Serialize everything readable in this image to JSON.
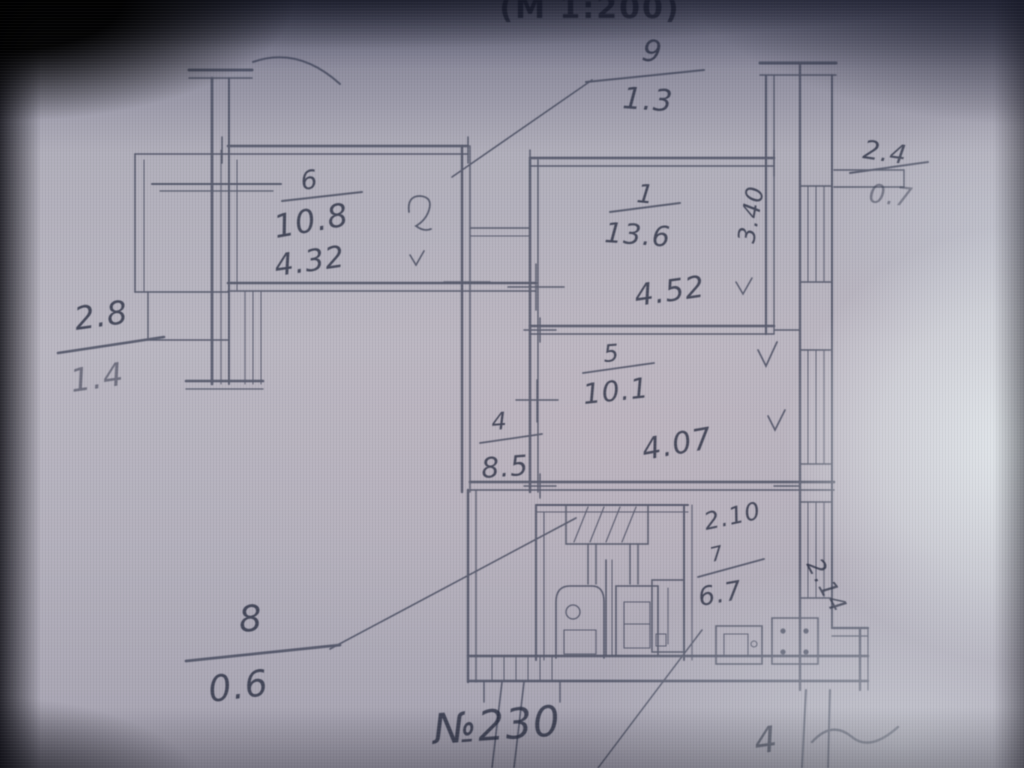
{
  "plan": {
    "scale_label": "(М 1:200)",
    "apartment_label": "№230",
    "corner_mark": "4",
    "rooms": {
      "room6": {
        "number": "6",
        "area": "10.8",
        "width": "4.32"
      },
      "room1": {
        "number": "1",
        "area": "13.6",
        "width": "4.52",
        "depth": "3.40"
      },
      "room5": {
        "number": "5",
        "area": "10.1",
        "width": "4.07"
      },
      "room4": {
        "number": "4",
        "area": "8.5"
      },
      "room7": {
        "number": "7",
        "area": "6.7",
        "dim_top": "2.10",
        "dim_side": "2.14"
      },
      "room8": {
        "number": "8",
        "area": "0.6"
      },
      "room9": {
        "number": "9",
        "area": "1.3"
      }
    },
    "balcony_left": {
      "width": "2.8",
      "area": "1.4"
    },
    "balcony_right": {
      "width": "2.4",
      "area": "0.7"
    }
  }
}
